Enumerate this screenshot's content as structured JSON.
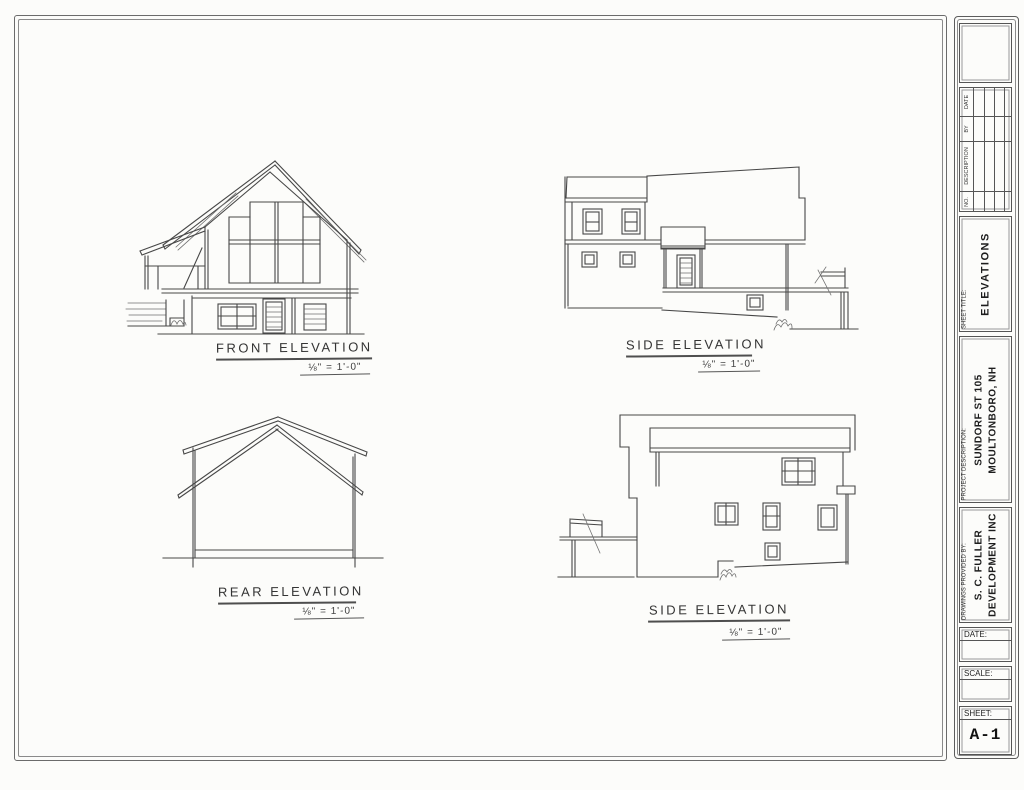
{
  "drawings": [
    {
      "id": "front",
      "title": "FRONT ELEVATION",
      "scale": "⅛\" = 1'-0\""
    },
    {
      "id": "side-upper",
      "title": "SIDE ELEVATION",
      "scale": "⅛\" = 1'-0\""
    },
    {
      "id": "rear",
      "title": "REAR ELEVATION",
      "scale": "⅛\" = 1'-0\""
    },
    {
      "id": "side-lower",
      "title": "SIDE ELEVATION",
      "scale": "⅛\" = 1'-0\""
    }
  ],
  "title_block": {
    "revision_columns": [
      "NO.",
      "DESCRIPTION",
      "BY",
      "DATE"
    ],
    "sheet_title_label": "SHEET TITLE:",
    "sheet_title": "ELEVATIONS",
    "project_label": "PROJECT DESCRIPTION:",
    "project_lines": [
      "SUNDORF ST 105",
      "MOULTONBORO, NH"
    ],
    "provided_label": "DRAWINGS PROVIDED BY:",
    "provided_lines": [
      "S. C. FULLER",
      "DEVELOPMENT INC"
    ],
    "date_label": "DATE:",
    "scale_label": "SCALE:",
    "sheet_label": "SHEET:",
    "sheet_number": "A-1"
  },
  "colors": {
    "line": "#474747",
    "paper": "#fcfcfa"
  }
}
